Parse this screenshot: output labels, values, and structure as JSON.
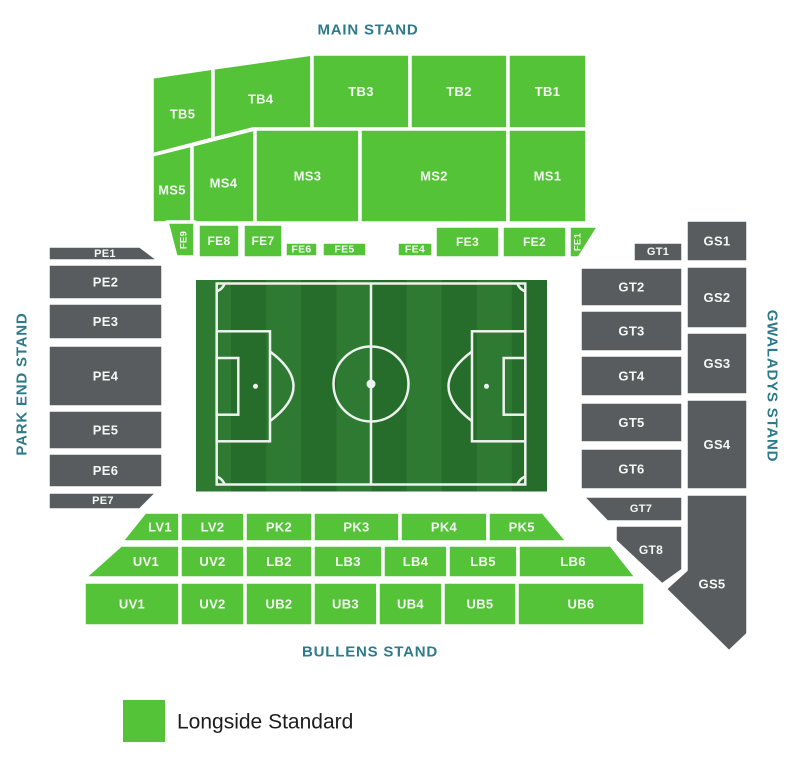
{
  "colors": {
    "longside_green": "#55c337",
    "end_gray": "#585c5f",
    "stand_label_teal": "#2c7a8a",
    "section_label_white": "#f4f7f4",
    "legend_text": "#1d1d1d",
    "pitch_light": "#2e7a33",
    "pitch_dark": "#266c2b",
    "pitch_line": "#eef2ee"
  },
  "stand_labels": {
    "main": "MAIN STAND",
    "park_end": "PARK END STAND",
    "gwaladys": "GWALADYS STAND",
    "bullens": "BULLENS STAND"
  },
  "legend": {
    "items": [
      {
        "label": "Longside Standard",
        "color": "#55c337"
      }
    ]
  },
  "sections": [
    {
      "id": "TB5",
      "stand": "main",
      "kind": "longside",
      "points": "152,77 213,68 213,139 152,155",
      "ly": 114
    },
    {
      "id": "TB4",
      "stand": "main",
      "kind": "longside",
      "points": "213,68 312,54 312,129 253,129 213,139",
      "ly": 99
    },
    {
      "id": "TB3",
      "stand": "main",
      "kind": "longside",
      "points": "312,54 410,54 410,129 312,129"
    },
    {
      "id": "TB2",
      "stand": "main",
      "kind": "longside",
      "points": "410,54 508,54 508,129 410,129"
    },
    {
      "id": "TB1",
      "stand": "main",
      "kind": "longside",
      "points": "508,54 587,54 587,129 508,129"
    },
    {
      "id": "MS5",
      "stand": "main",
      "kind": "longside",
      "points": "152,155 192,145 192,223 152,223",
      "ly": 190
    },
    {
      "id": "MS4",
      "stand": "main",
      "kind": "longside",
      "points": "192,145 255,129 255,223 192,223",
      "ly": 183
    },
    {
      "id": "MS3",
      "stand": "main",
      "kind": "longside",
      "points": "255,129 360,129 360,223 255,223"
    },
    {
      "id": "MS2",
      "stand": "main",
      "kind": "longside",
      "points": "360,129 508,129 508,223 360,223"
    },
    {
      "id": "MS1",
      "stand": "main",
      "kind": "longside",
      "points": "508,129 587,129 587,223 508,223"
    },
    {
      "id": "FE9",
      "stand": "main",
      "kind": "longside",
      "points": "167,222 195,222 195,257 176,257",
      "fs": 9.5,
      "rot": -90,
      "lx": 184,
      "ly": 240
    },
    {
      "id": "FE8",
      "stand": "main",
      "kind": "longside",
      "points": "198,224 240,224 240,258 198,258",
      "fs": 12
    },
    {
      "id": "FE7",
      "stand": "main",
      "kind": "longside",
      "points": "243,224 283,224 283,258 243,258",
      "fs": 12
    },
    {
      "id": "FE6",
      "stand": "main",
      "kind": "longside",
      "points": "285,242 318,242 318,257 285,257",
      "fs": 10.5
    },
    {
      "id": "FE5",
      "stand": "main",
      "kind": "longside",
      "points": "322,242 367,242 367,257 322,257",
      "fs": 10.5
    },
    {
      "id": "FE4",
      "stand": "main",
      "kind": "longside",
      "points": "397,242 433,242 433,257 397,257",
      "fs": 10.5
    },
    {
      "id": "FE3",
      "stand": "main",
      "kind": "longside",
      "points": "435,226 500,226 500,258 435,258",
      "fs": 12
    },
    {
      "id": "FE2",
      "stand": "main",
      "kind": "longside",
      "points": "502,226 567,226 567,258 502,258",
      "fs": 12
    },
    {
      "id": "FE1",
      "stand": "main",
      "kind": "longside",
      "points": "569,226 599,226 579,258 569,258",
      "fs": 9.5,
      "rot": -90,
      "lx": 578,
      "ly": 242
    },
    {
      "id": "PE1",
      "stand": "park_end",
      "kind": "end",
      "points": "48,246 140,246 160,261 48,261",
      "fs": 11,
      "lx": 105,
      "ly": 254
    },
    {
      "id": "PE2",
      "stand": "park_end",
      "kind": "end",
      "points": "48,264 163,264 163,300 48,300"
    },
    {
      "id": "PE3",
      "stand": "park_end",
      "kind": "end",
      "points": "48,303 163,303 163,340 48,340"
    },
    {
      "id": "PE4",
      "stand": "park_end",
      "kind": "end",
      "points": "48,345 163,345 163,407 48,407"
    },
    {
      "id": "PE5",
      "stand": "park_end",
      "kind": "end",
      "points": "48,410 163,410 163,450 48,450"
    },
    {
      "id": "PE6",
      "stand": "park_end",
      "kind": "end",
      "points": "48,453 163,453 163,488 48,488"
    },
    {
      "id": "PE7",
      "stand": "park_end",
      "kind": "end",
      "points": "48,492 158,492 140,510 48,510",
      "fs": 11,
      "lx": 103,
      "ly": 501
    },
    {
      "id": "GT1",
      "stand": "gwaladys",
      "kind": "end",
      "points": "633,242 683,242 683,262 633,262",
      "fs": 11
    },
    {
      "id": "GT2",
      "stand": "gwaladys",
      "kind": "end",
      "points": "580,267 683,267 683,307 580,307"
    },
    {
      "id": "GT3",
      "stand": "gwaladys",
      "kind": "end",
      "points": "580,310 683,310 683,352 580,352"
    },
    {
      "id": "GT4",
      "stand": "gwaladys",
      "kind": "end",
      "points": "580,355 683,355 683,397 580,397"
    },
    {
      "id": "GT5",
      "stand": "gwaladys",
      "kind": "end",
      "points": "580,402 683,402 683,443 580,443"
    },
    {
      "id": "GT6",
      "stand": "gwaladys",
      "kind": "end",
      "points": "580,448 683,448 683,490 580,490"
    },
    {
      "id": "GT7",
      "stand": "gwaladys",
      "kind": "end",
      "points": "582,496 683,496 683,522 607,522",
      "fs": 11,
      "lx": 641,
      "ly": 509
    },
    {
      "id": "GT8",
      "stand": "gwaladys",
      "kind": "end",
      "points": "615,525 683,525 683,570 662,585 615,541",
      "fs": 12,
      "lx": 651,
      "ly": 550
    },
    {
      "id": "GS1",
      "stand": "gwaladys",
      "kind": "end",
      "points": "686,220 748,220 748,262 686,262"
    },
    {
      "id": "GS2",
      "stand": "gwaladys",
      "kind": "end",
      "points": "686,266 748,266 748,329 686,329"
    },
    {
      "id": "GS3",
      "stand": "gwaladys",
      "kind": "end",
      "points": "686,332 748,332 748,395 686,395"
    },
    {
      "id": "GS4",
      "stand": "gwaladys",
      "kind": "end",
      "points": "686,399 748,399 748,490 686,490"
    },
    {
      "id": "GS5",
      "stand": "gwaladys",
      "kind": "end",
      "points": "686,494 748,494 748,634 729,652 665,589 686,570",
      "lx": 712,
      "ly": 584
    },
    {
      "id": "LV1",
      "stand": "bullens",
      "kind": "longside",
      "points": "145,512 180,512 180,542 121,542",
      "lx": 160
    },
    {
      "id": "LV2",
      "stand": "bullens",
      "kind": "longside",
      "points": "180,512 245,512 245,542 180,542"
    },
    {
      "id": "PK2",
      "stand": "bullens",
      "kind": "longside",
      "points": "245,512 313,512 313,542 245,542"
    },
    {
      "id": "PK3",
      "stand": "bullens",
      "kind": "longside",
      "points": "313,512 400,512 400,542 313,542"
    },
    {
      "id": "PK4",
      "stand": "bullens",
      "kind": "longside",
      "points": "400,512 488,512 488,542 400,542"
    },
    {
      "id": "PK5",
      "stand": "bullens",
      "kind": "longside",
      "points": "488,512 543,512 568,542 488,542"
    },
    {
      "id": "UV1",
      "key": "UV1-middle",
      "stand": "bullens",
      "kind": "longside",
      "points": "121,545 180,545 180,578 84,578",
      "lx": 146
    },
    {
      "id": "UV2",
      "key": "UV2-middle",
      "stand": "bullens",
      "kind": "longside",
      "points": "180,545 245,545 245,578 180,578"
    },
    {
      "id": "LB2",
      "stand": "bullens",
      "kind": "longside",
      "points": "245,545 313,545 313,578 245,578"
    },
    {
      "id": "LB3",
      "stand": "bullens",
      "kind": "longside",
      "points": "313,545 383,545 383,578 313,578"
    },
    {
      "id": "LB4",
      "stand": "bullens",
      "kind": "longside",
      "points": "383,545 448,545 448,578 383,578"
    },
    {
      "id": "LB5",
      "stand": "bullens",
      "kind": "longside",
      "points": "448,545 518,545 518,578 448,578"
    },
    {
      "id": "LB6",
      "stand": "bullens",
      "kind": "longside",
      "points": "518,545 611,545 637,578 518,578",
      "lx": 573
    },
    {
      "id": "UV1",
      "key": "UV1-front",
      "stand": "bullens",
      "kind": "longside",
      "points": "84,582 180,582 180,626 84,626"
    },
    {
      "id": "UV2",
      "key": "UV2-front",
      "stand": "bullens",
      "kind": "longside",
      "points": "180,582 245,582 245,626 180,626"
    },
    {
      "id": "UB2",
      "stand": "bullens",
      "kind": "longside",
      "points": "245,582 313,582 313,626 245,626"
    },
    {
      "id": "UB3",
      "stand": "bullens",
      "kind": "longside",
      "points": "313,582 378,582 378,626 313,626"
    },
    {
      "id": "UB4",
      "stand": "bullens",
      "kind": "longside",
      "points": "378,582 443,582 443,626 378,626"
    },
    {
      "id": "UB5",
      "stand": "bullens",
      "kind": "longside",
      "points": "443,582 517,582 517,626 443,626"
    },
    {
      "id": "UB6",
      "stand": "bullens",
      "kind": "longside",
      "points": "517,582 645,582 645,626 517,626"
    }
  ]
}
